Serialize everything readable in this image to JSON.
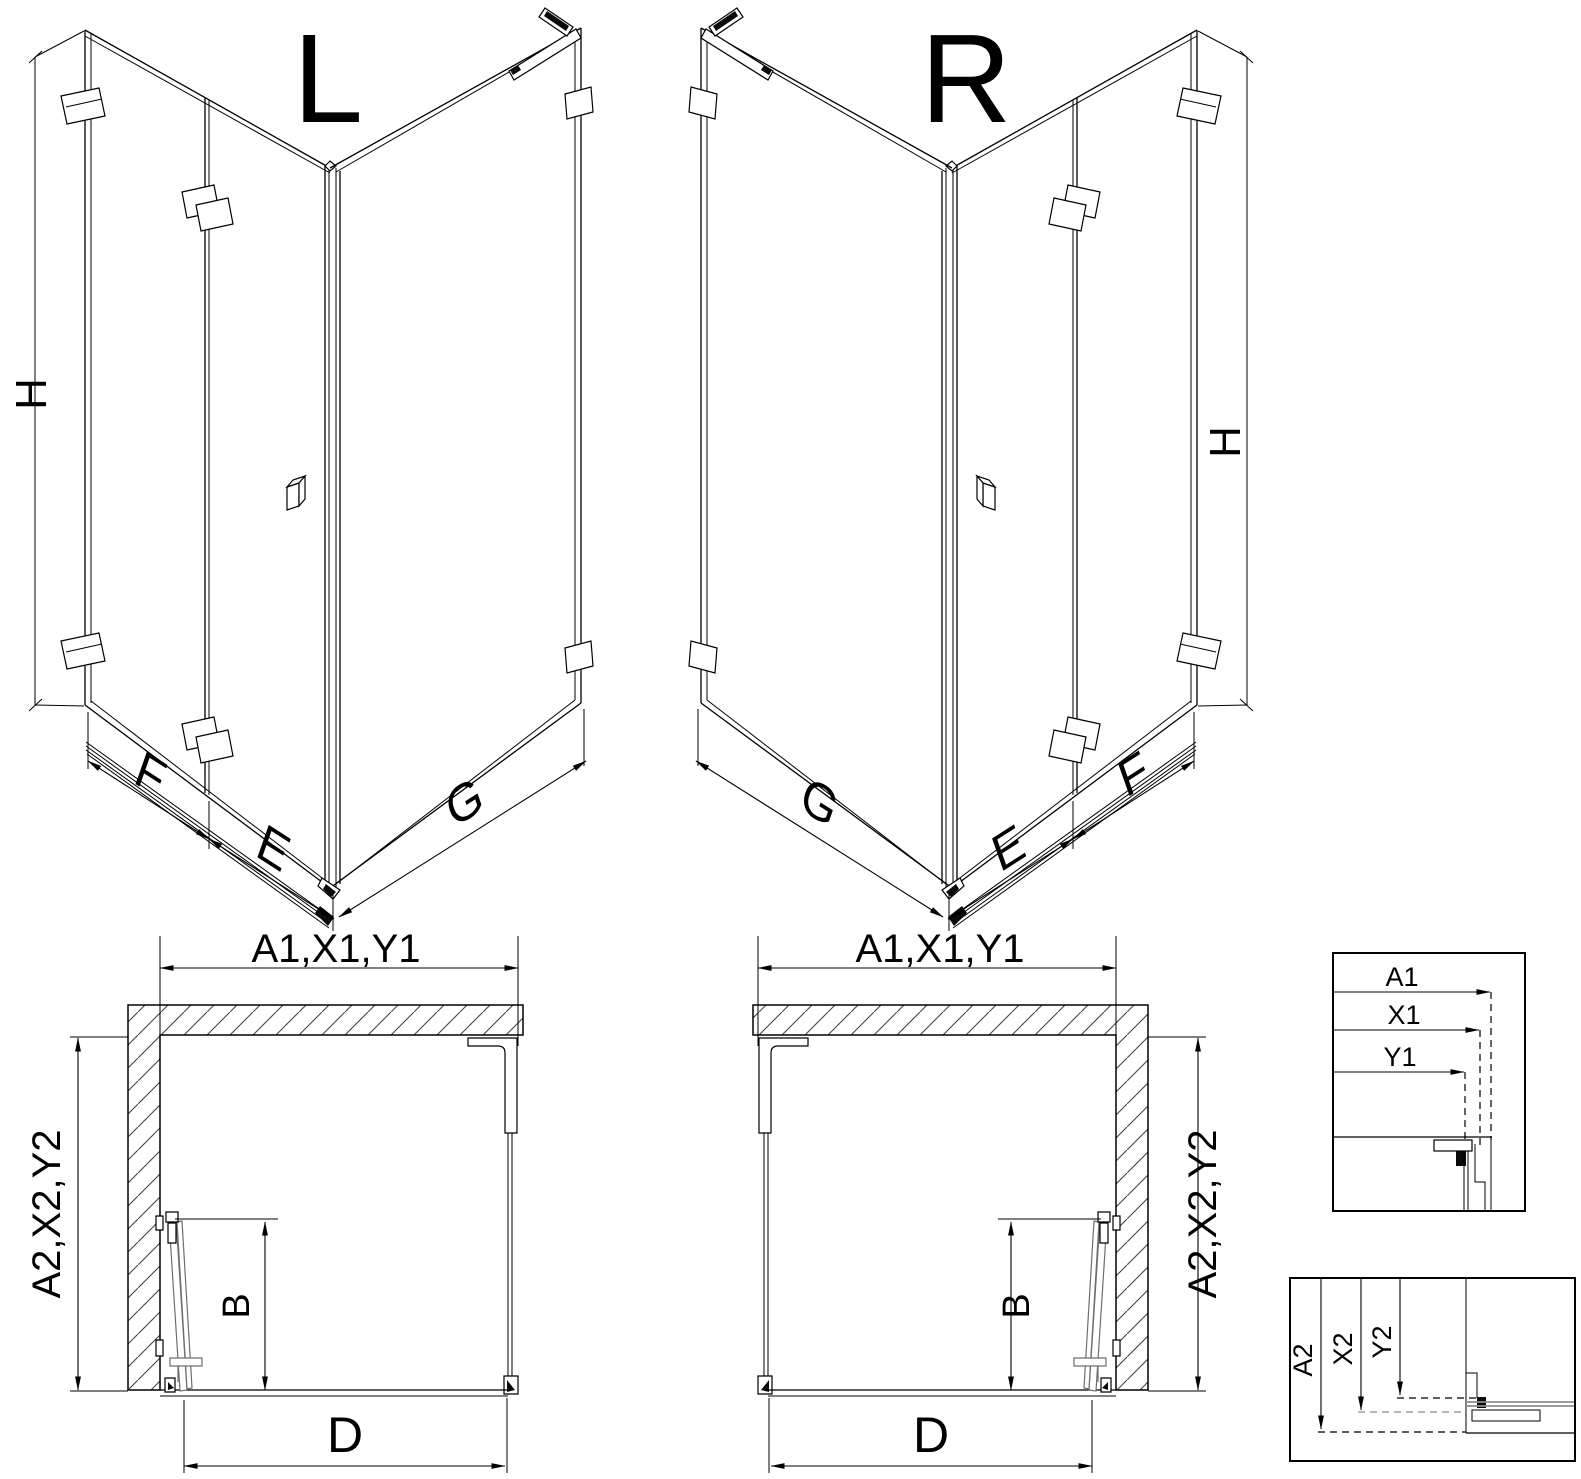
{
  "diagram": {
    "iso_left": {
      "variant_label": "L",
      "height_label": "H",
      "segment_labels": {
        "f": "F",
        "e": "E",
        "g": "G"
      }
    },
    "iso_right": {
      "variant_label": "R",
      "height_label": "H",
      "segment_labels": {
        "f": "F",
        "e": "E",
        "g": "G"
      }
    },
    "plan_left": {
      "width_label": "A1,X1,Y1",
      "depth_label": "A2,X2,Y2",
      "door_label": "B",
      "entry_label": "D"
    },
    "plan_right": {
      "width_label": "A1,X1,Y1",
      "depth_label": "A2,X2,Y2",
      "door_label": "B",
      "entry_label": "D"
    },
    "detail_width_offsets": {
      "labels": [
        "A1",
        "X1",
        "Y1"
      ]
    },
    "detail_depth_offsets": {
      "labels": [
        "A2",
        "X2",
        "Y2"
      ]
    }
  },
  "colors": {
    "line": "#000000",
    "muted": "#8c8c8c",
    "background": "#ffffff"
  }
}
